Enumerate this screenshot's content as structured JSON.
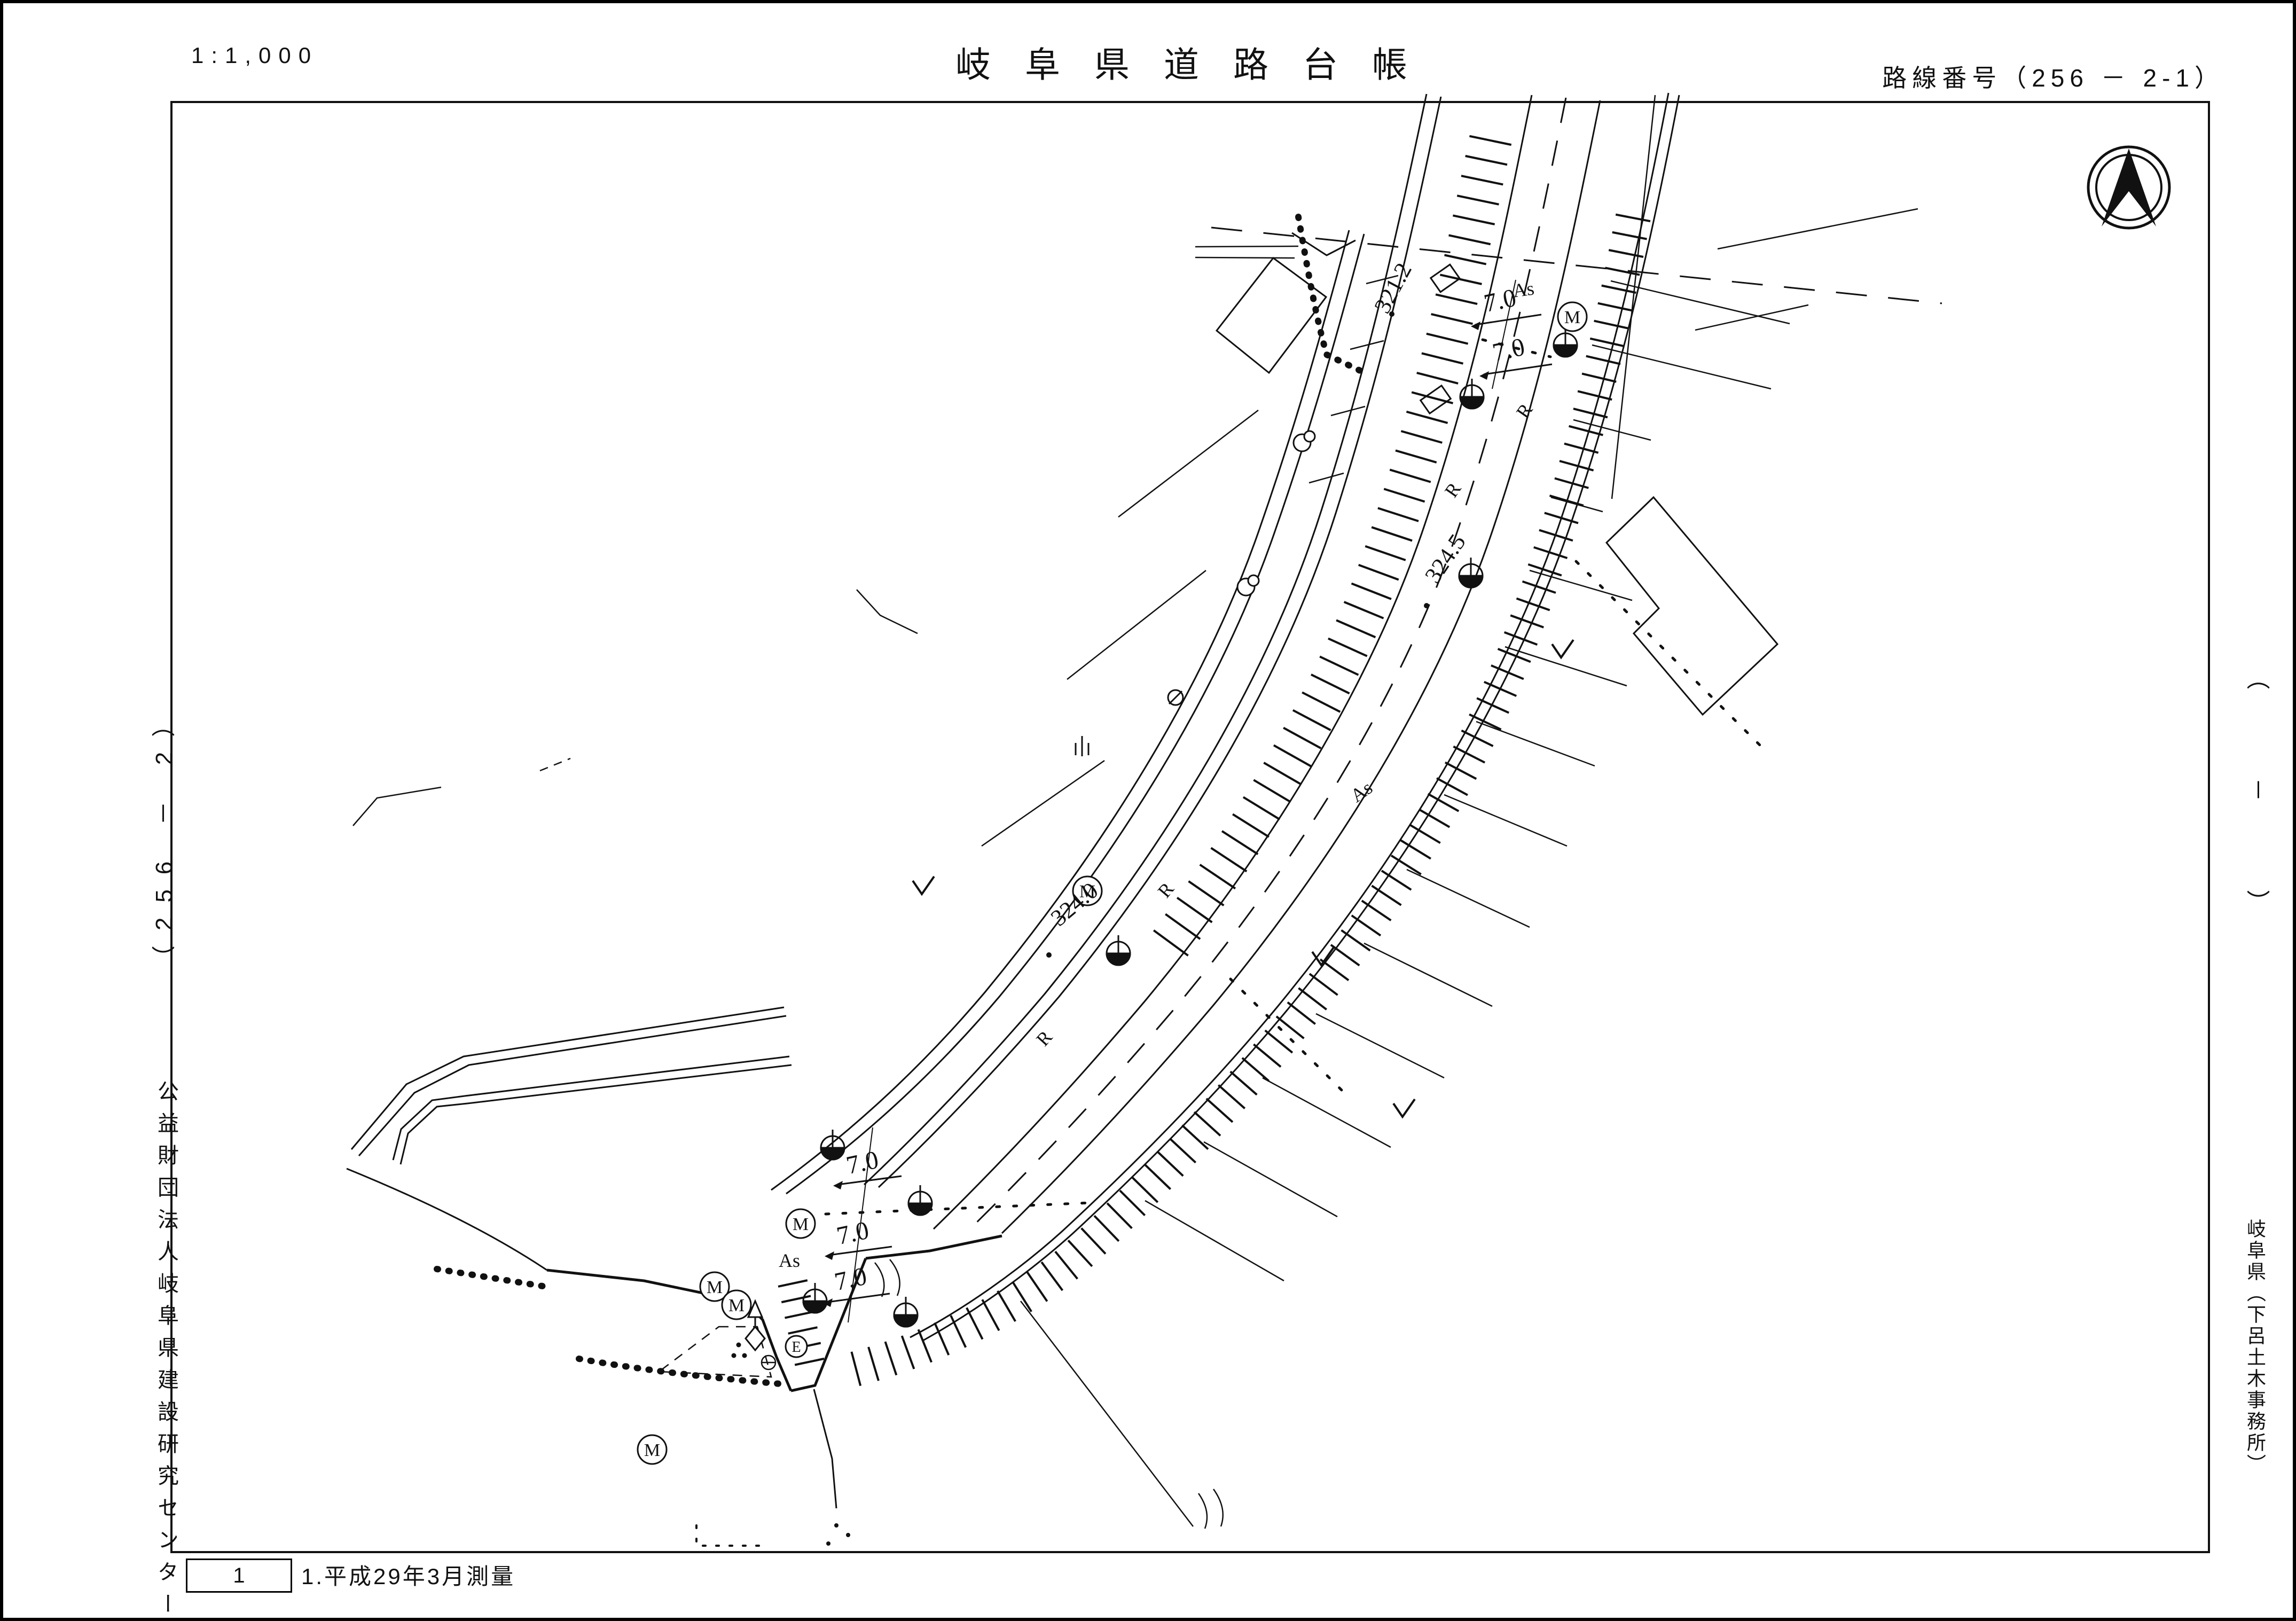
{
  "header": {
    "scale": "1:1,000",
    "title": "岐阜県道路台帳",
    "route_label": "路線番号（256 － 2-1）"
  },
  "left_margin": {
    "sheet_label": "（256 － 2）",
    "organization": "公益財団法人岐阜県建設研究センター"
  },
  "right_margin": {
    "sheet_label": "（－）",
    "organization": "岐阜県（下呂土木事務所）"
  },
  "footer": {
    "sheet_number": "1",
    "survey_note": "1.平成29年3月測量"
  },
  "map": {
    "spot_elevations": [
      {
        "value": "321.2"
      },
      {
        "value": "324.5"
      },
      {
        "value": "324.0"
      }
    ],
    "road_widths": [
      "7.0",
      "7.0",
      "7.0",
      "7.0",
      "7.0"
    ],
    "surface_labels": [
      "As",
      "As",
      "As"
    ],
    "curve_labels": [
      "R",
      "R",
      "R",
      "R"
    ],
    "manhole_letter": "M",
    "utility_letter": "E",
    "ink_color": "#111111"
  }
}
